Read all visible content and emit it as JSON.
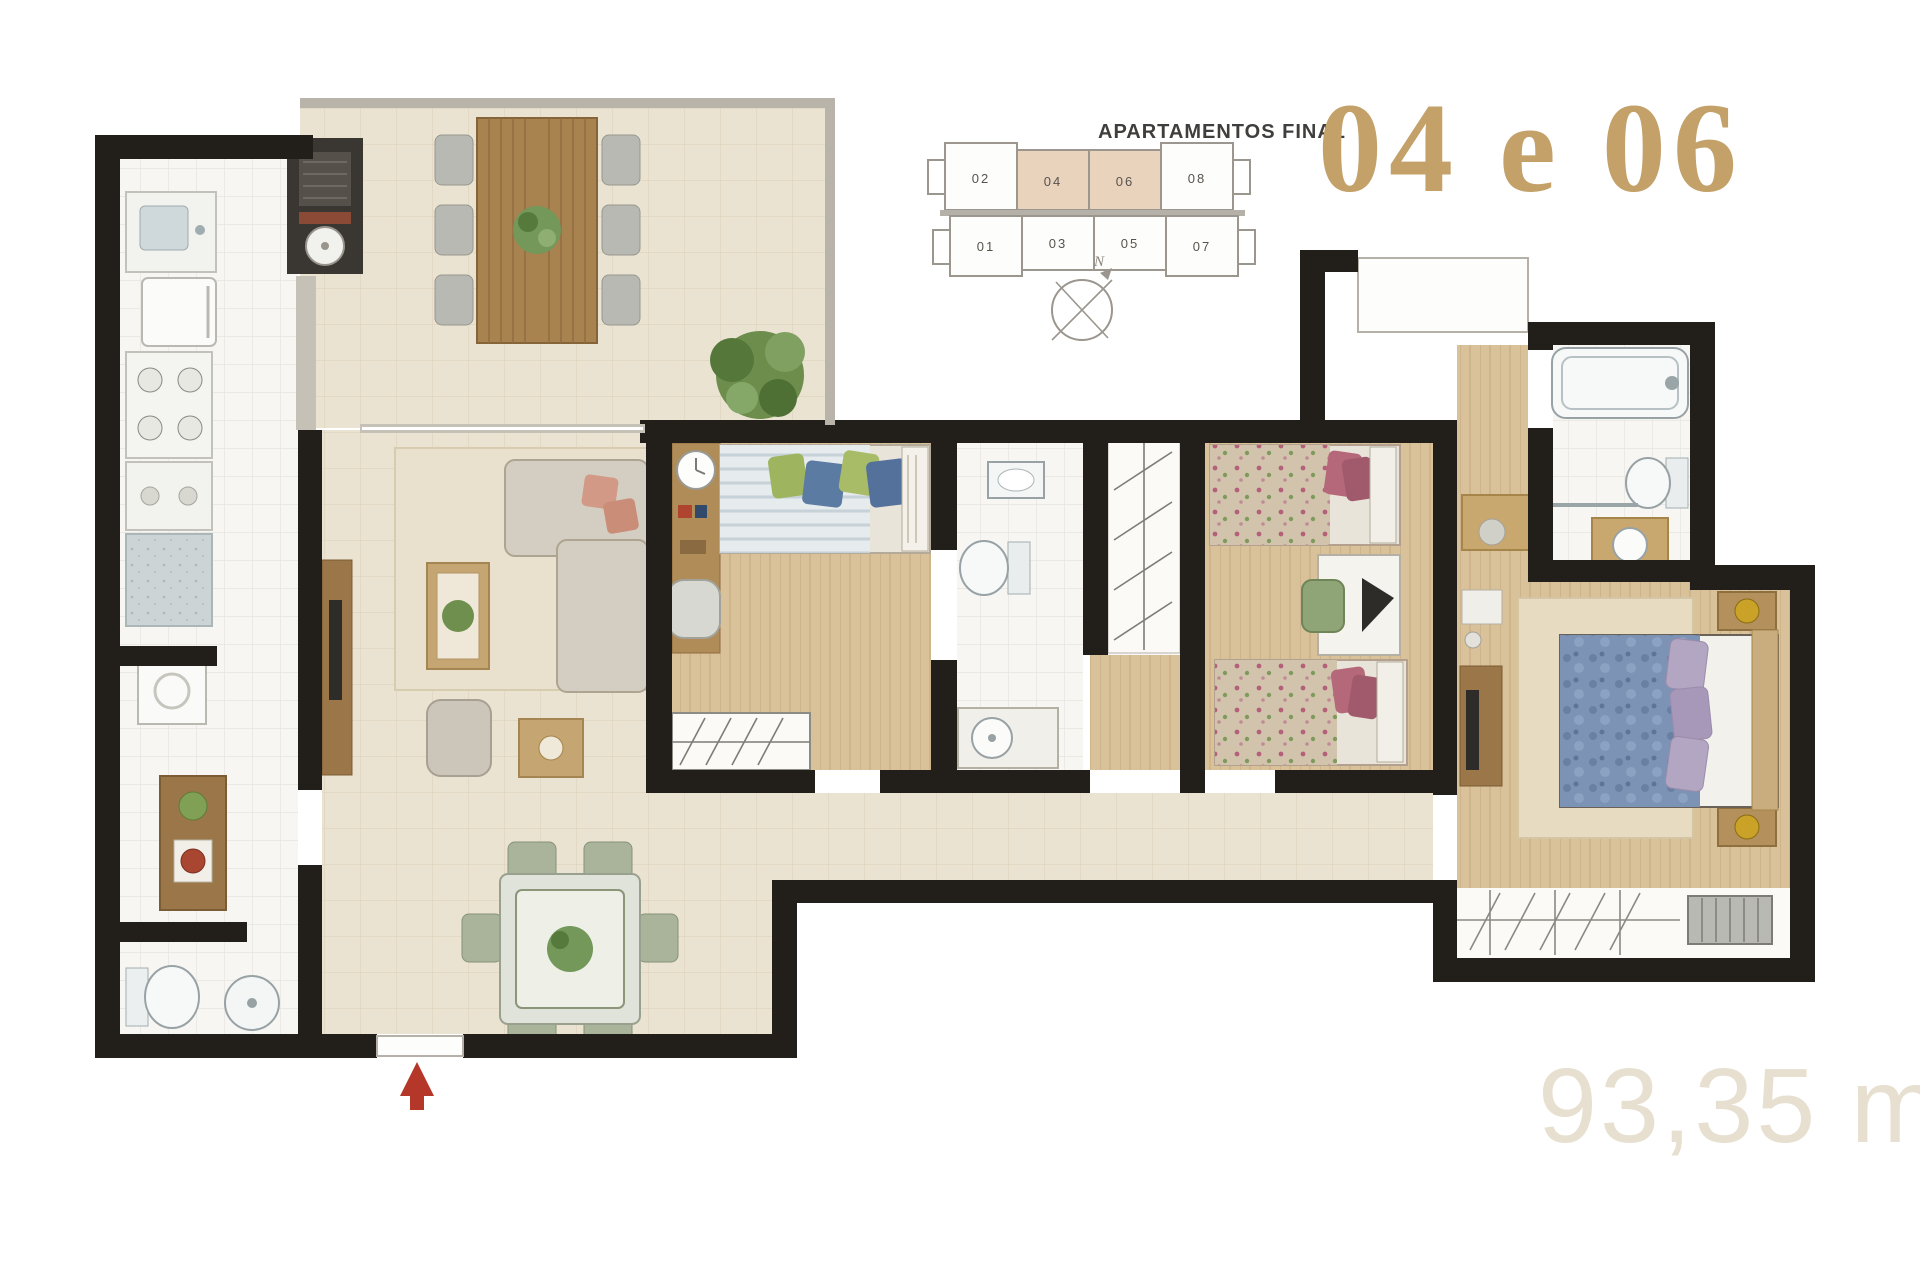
{
  "header": {
    "label": "APARTAMENTOS FINAL",
    "units": "04 e 06",
    "label_color": "#3f3e3c",
    "units_color": "#c3a169"
  },
  "area_label": {
    "text": "93,35 m²",
    "color": "#e7dfcf"
  },
  "key_plan": {
    "top_row": [
      "02",
      "04",
      "06",
      "08"
    ],
    "bottom_row": [
      "01",
      "03",
      "05",
      "07"
    ],
    "highlighted": [
      "04",
      "06"
    ],
    "highlight_color": "#e9d3bc",
    "outline_color": "#9b968e",
    "number_color": "#57534d",
    "compass_label": "N"
  },
  "plan": {
    "wall_color": "#221f1b",
    "tile_beige": "#ebe3d2",
    "tile_white": "#f7f6f3",
    "wood_floor": "#d9c199",
    "rug_color": "#e9e0cd",
    "sofa_color": "#d4cec2",
    "salmon_pillow": "#d29a86",
    "green_pillow": "#9fb45f",
    "blue_pillow": "#5c7ba3",
    "floral_bed": "#d2c4ac",
    "rose_pillow": "#b4687a",
    "master_bed_blue": "#7d93b5",
    "lavender_pillow": "#b3a6c2",
    "wood_furniture": "#a8824f",
    "chair_green": "#a9b49b",
    "plant_green": "#6f8f4f",
    "entry_arrow_red": "#b5372a",
    "lamp_gold": "#c9a227",
    "granite_blue": "#ccd4d6",
    "rail_gray": "#b9b4aa"
  }
}
